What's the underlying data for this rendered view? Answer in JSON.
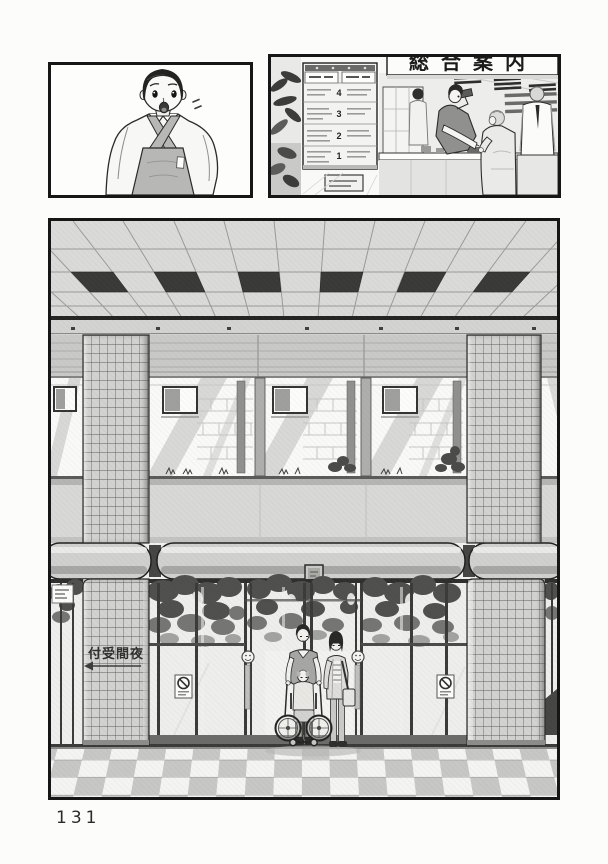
{
  "page": {
    "number": "131"
  },
  "colors": {
    "paper": "#fcfcfa",
    "ink": "#161616",
    "tone_light": "#dcdcda",
    "tone_mid": "#c4c4c2",
    "tone_dark": "#8c8c8a",
    "vent_dark": "#393937"
  },
  "info_counter_panel": {
    "wall_sign": "総合案内",
    "floor_directory": {
      "floors": [
        "4",
        "3",
        "2",
        "1"
      ]
    }
  },
  "entrance_panel": {
    "pillar_sign": "付受間夜"
  },
  "icons": {
    "no_smoking_sticker": "circle-slash",
    "automatic_door_sticker": "smiley-circle",
    "direction_arrow": "left-arrow"
  }
}
